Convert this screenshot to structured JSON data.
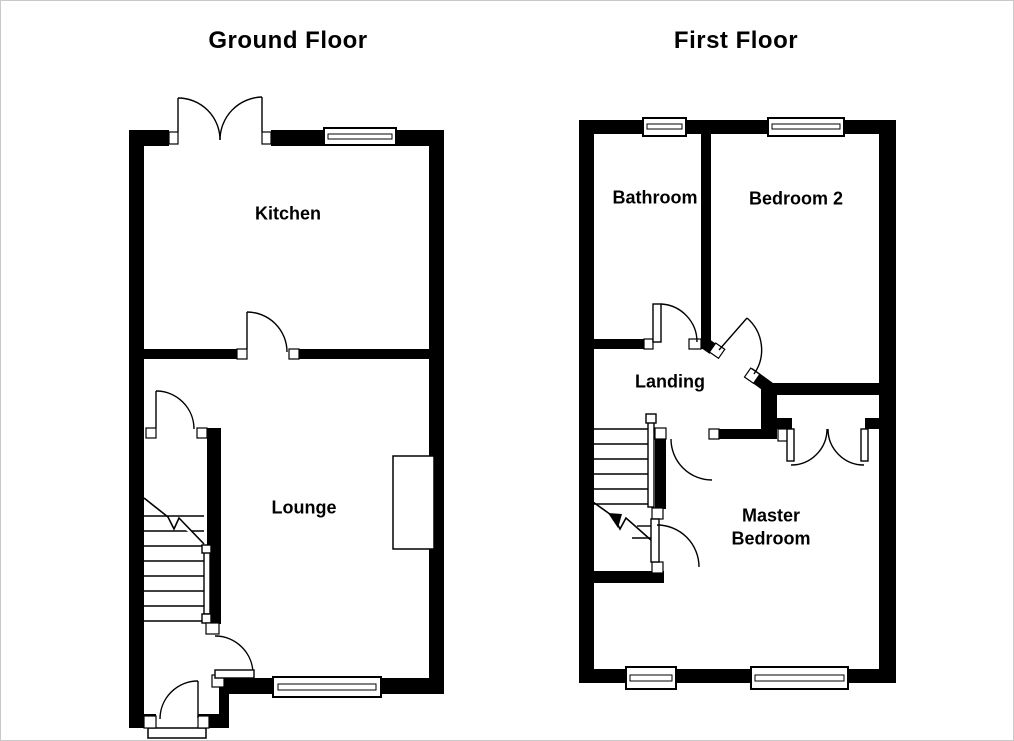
{
  "canvas": {
    "background": "#ffffff",
    "wall_color": "#000000",
    "line_color": "#000000",
    "text_color": "#000000"
  },
  "plans": [
    {
      "title": "Ground Floor",
      "rooms": [
        {
          "label": "Kitchen"
        },
        {
          "label": "Lounge"
        }
      ]
    },
    {
      "title": "First Floor",
      "rooms": [
        {
          "label": "Bathroom"
        },
        {
          "label": "Bedroom 2"
        },
        {
          "label": "Landing"
        },
        {
          "label": "Master Bedroom"
        }
      ]
    }
  ]
}
